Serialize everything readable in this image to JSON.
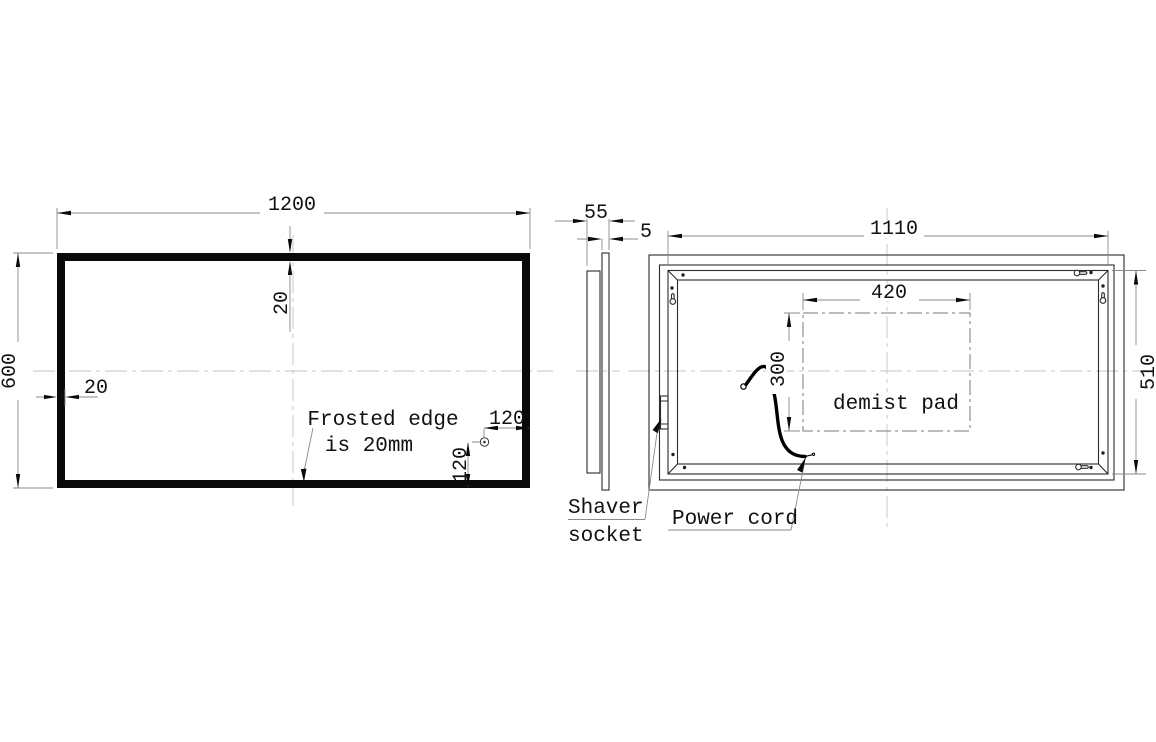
{
  "drawing_title": "LED mirror technical drawing",
  "colors": {
    "line": "#1a1a1a",
    "dim_line": "#8a8a8a",
    "background": "#ffffff"
  },
  "front_view": {
    "width_dim": "1200",
    "height_dim": "600",
    "top_edge_dim": "20",
    "left_edge_dim": "20",
    "note_line1": "Frosted edge",
    "note_line2": "is 20mm",
    "sensor_offset_x_dim": "120",
    "sensor_offset_y_dim": "120"
  },
  "side_view": {
    "depth_dim": "55",
    "glass_dim": "5"
  },
  "back_view": {
    "width_dim": "1110",
    "height_dim": "510",
    "pad_width_dim": "420",
    "pad_height_dim": "300",
    "pad_label": "demist pad",
    "shaver_label_line1": "Shaver",
    "shaver_label_line2": "socket",
    "power_cord_label": "Power cord"
  }
}
